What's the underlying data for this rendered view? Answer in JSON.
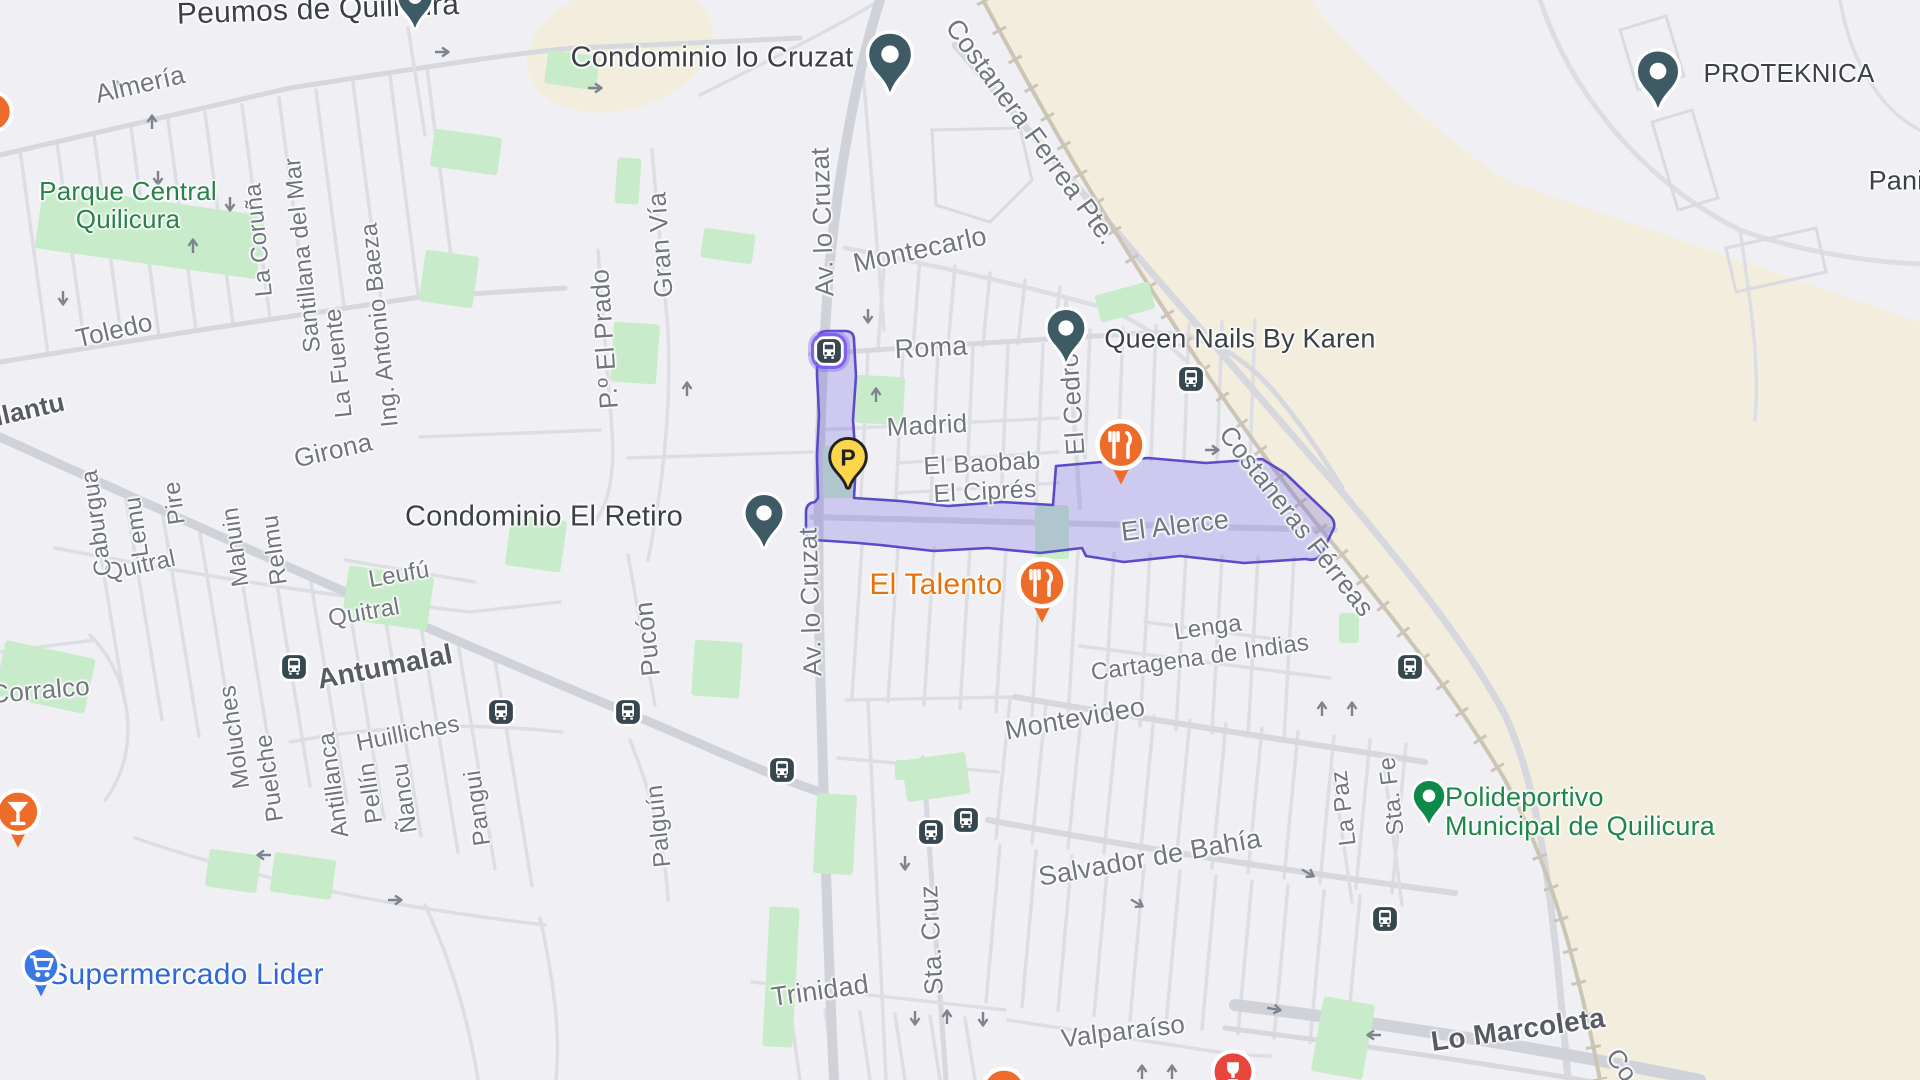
{
  "map": {
    "title": "Quilicura area street map",
    "selection": "El Alerce highlighted route"
  },
  "colors": {
    "bg": "#f0f0f4",
    "beige": "#f3edde",
    "park": "#c8ecca",
    "road": "#dcdee3",
    "road_mid": "#d6d8de",
    "road_major": "#cfd2d8",
    "rail": "#cbc5b6",
    "building": "#d9dbe0",
    "purple_fill": "rgba(106,90,225,0.26)",
    "purple_stroke": "#5b4bc8",
    "bus_bg": "#37474f",
    "pin_slate": "#3e5a64",
    "pin_green": "#0d8a47",
    "poi_orange": "#ee6c2a",
    "poi_blue": "#3b78e7",
    "poi_red": "#e8453c",
    "parking_yellow": "#fdd64b"
  },
  "labels": [
    {
      "n": "peumos-de-quilicura",
      "t": "Peumos de Quilicura",
      "x": 318,
      "y": 10,
      "r": -2,
      "s": 30,
      "c": "poi",
      "i": true
    },
    {
      "n": "condominio-lo-cruzat",
      "t": "Condominio lo Cruzat",
      "x": 712,
      "y": 58,
      "r": 0,
      "s": 29,
      "c": "poi",
      "i": true
    },
    {
      "n": "proteknica",
      "t": "PROTEKNICA",
      "x": 1789,
      "y": 73,
      "r": 0,
      "s": 26,
      "c": "poi",
      "i": true
    },
    {
      "n": "pani",
      "t": "Pani",
      "x": 1896,
      "y": 181,
      "r": 0,
      "s": 27,
      "c": "poi",
      "i": true
    },
    {
      "n": "queen-nails-by-karen",
      "t": "Queen Nails By Karen",
      "x": 1240,
      "y": 339,
      "r": 0,
      "s": 27,
      "c": "poi",
      "i": true
    },
    {
      "n": "condominio-el-retiro",
      "t": "Condominio El Retiro",
      "x": 544,
      "y": 517,
      "r": 0,
      "s": 29,
      "c": "poi",
      "i": true
    },
    {
      "n": "parque-central-quilicura",
      "t": "Parque Central\nQuilicura",
      "x": 128,
      "y": 205,
      "r": 0,
      "s": 26,
      "c": "park",
      "i": true
    },
    {
      "n": "polideportivo",
      "t": "Polideportivo\nMunicipal de Quilicura",
      "x": 1580,
      "y": 812,
      "r": 0,
      "s": 27,
      "c": "green",
      "i": true
    },
    {
      "n": "supermercado-lider",
      "t": "Supermercado Lider",
      "x": 186,
      "y": 975,
      "r": 0,
      "s": 30,
      "c": "blue",
      "i": true
    },
    {
      "n": "el-talento",
      "t": "El Talento",
      "x": 936,
      "y": 585,
      "r": 0,
      "s": 30,
      "c": "orange",
      "i": true
    },
    {
      "n": "almeria",
      "t": "Almería",
      "x": 140,
      "y": 84,
      "r": -13,
      "s": 26,
      "c": "st",
      "i": false
    },
    {
      "n": "toledo",
      "t": "Toledo",
      "x": 114,
      "y": 330,
      "r": -13,
      "s": 26,
      "c": "st",
      "i": false
    },
    {
      "n": "illantu",
      "t": "illantu",
      "x": 26,
      "y": 410,
      "r": -13,
      "s": 26,
      "c": "stm",
      "i": false
    },
    {
      "n": "girona",
      "t": "Girona",
      "x": 333,
      "y": 450,
      "r": -13,
      "s": 26,
      "c": "st",
      "i": false
    },
    {
      "n": "montecarlo",
      "t": "Montecarlo",
      "x": 920,
      "y": 250,
      "r": -12,
      "s": 27,
      "c": "st",
      "i": false
    },
    {
      "n": "roma",
      "t": "Roma",
      "x": 931,
      "y": 348,
      "r": -3,
      "s": 27,
      "c": "st",
      "i": false
    },
    {
      "n": "madrid",
      "t": "Madrid",
      "x": 927,
      "y": 425,
      "r": -3,
      "s": 26,
      "c": "st",
      "i": false
    },
    {
      "n": "el-baobab",
      "t": "El Baobab",
      "x": 982,
      "y": 464,
      "r": -3,
      "s": 25,
      "c": "st",
      "i": false
    },
    {
      "n": "el-cipres",
      "t": "El Ciprés",
      "x": 985,
      "y": 492,
      "r": -3,
      "s": 25,
      "c": "st",
      "i": false
    },
    {
      "n": "el-alerce",
      "t": "El Alerce",
      "x": 1175,
      "y": 526,
      "r": -7,
      "s": 27,
      "c": "st",
      "i": false
    },
    {
      "n": "lenga",
      "t": "Lenga",
      "x": 1208,
      "y": 628,
      "r": -8,
      "s": 24,
      "c": "st",
      "i": false
    },
    {
      "n": "cartagena-de-indias",
      "t": "Cartagena de Indias",
      "x": 1200,
      "y": 658,
      "r": -8,
      "s": 24,
      "c": "st",
      "i": false
    },
    {
      "n": "montevideo",
      "t": "Montevideo",
      "x": 1075,
      "y": 719,
      "r": -10,
      "s": 27,
      "c": "st",
      "i": false
    },
    {
      "n": "salvador-de-bahia",
      "t": "Salvador de Bahía",
      "x": 1150,
      "y": 858,
      "r": -10,
      "s": 27,
      "c": "st",
      "i": false
    },
    {
      "n": "trinidad",
      "t": "Trinidad",
      "x": 820,
      "y": 991,
      "r": -8,
      "s": 27,
      "c": "st",
      "i": false
    },
    {
      "n": "valparaiso",
      "t": "Valparaíso",
      "x": 1123,
      "y": 1031,
      "r": -7,
      "s": 26,
      "c": "st",
      "i": false
    },
    {
      "n": "lo-marcoleta",
      "t": "Lo Marcoleta",
      "x": 1518,
      "y": 1030,
      "r": -8,
      "s": 28,
      "c": "stm",
      "i": false
    },
    {
      "n": "antumalal",
      "t": "Antumalal",
      "x": 385,
      "y": 667,
      "r": -11,
      "s": 28,
      "c": "stm",
      "i": false
    },
    {
      "n": "quitral-west",
      "t": "Quitral",
      "x": 140,
      "y": 566,
      "r": -12,
      "s": 24,
      "c": "st",
      "i": false
    },
    {
      "n": "quitral-east",
      "t": "Quitral",
      "x": 364,
      "y": 613,
      "r": -10,
      "s": 24,
      "c": "st",
      "i": false
    },
    {
      "n": "leufu",
      "t": "Leufú",
      "x": 399,
      "y": 575,
      "r": -10,
      "s": 24,
      "c": "st",
      "i": false
    },
    {
      "n": "huilliches",
      "t": "Huilliches",
      "x": 408,
      "y": 734,
      "r": -11,
      "s": 24,
      "c": "st",
      "i": false
    },
    {
      "n": "corralco",
      "t": "Corralco",
      "x": 40,
      "y": 690,
      "r": -5,
      "s": 26,
      "c": "st",
      "i": false
    },
    {
      "n": "costanera-ferrea-pte",
      "t": "Costanera Ferrea Pte.",
      "x": 1031,
      "y": 132,
      "r": 54,
      "s": 27,
      "c": "st",
      "i": false
    },
    {
      "n": "costaneras-ferreas",
      "t": "Costaneras Férreas",
      "x": 1297,
      "y": 521,
      "r": 52,
      "s": 26,
      "c": "st",
      "i": false
    },
    {
      "n": "costanera-co",
      "t": "Co",
      "x": 1622,
      "y": 1065,
      "r": 55,
      "s": 26,
      "c": "st",
      "i": false
    },
    {
      "n": "la-coruna",
      "t": "La Coruña",
      "x": 259,
      "y": 240,
      "r": -96,
      "s": 24,
      "c": "st",
      "i": false
    },
    {
      "n": "santillana-del-mar",
      "t": "Santillana del Mar",
      "x": 303,
      "y": 255,
      "r": -96,
      "s": 24,
      "c": "st",
      "i": false
    },
    {
      "n": "la-fuente",
      "t": "La Fuente",
      "x": 339,
      "y": 363,
      "r": -96,
      "s": 24,
      "c": "st",
      "i": false
    },
    {
      "n": "ing-antonio-baeza",
      "t": "Ing. Antonio Baeza",
      "x": 380,
      "y": 325,
      "r": -96,
      "s": 24,
      "c": "st",
      "i": false
    },
    {
      "n": "gran-via",
      "t": "Gran Vía",
      "x": 660,
      "y": 245,
      "r": -94,
      "s": 26,
      "c": "st",
      "i": false
    },
    {
      "n": "po-el-prado",
      "t": "P.º El Prado",
      "x": 604,
      "y": 339,
      "r": -94,
      "s": 26,
      "c": "st",
      "i": false
    },
    {
      "n": "av-lo-cruzat-n",
      "t": "Av. lo Cruzat",
      "x": 822,
      "y": 222,
      "r": -92,
      "s": 26,
      "c": "st",
      "i": false
    },
    {
      "n": "av-lo-cruzat-s",
      "t": "Av. lo Cruzat",
      "x": 810,
      "y": 602,
      "r": -92,
      "s": 26,
      "c": "st",
      "i": false
    },
    {
      "n": "caburgua",
      "t": "Caburgua",
      "x": 97,
      "y": 523,
      "r": -98,
      "s": 24,
      "c": "st",
      "i": false
    },
    {
      "n": "lemu",
      "t": "Lemu",
      "x": 137,
      "y": 527,
      "r": -98,
      "s": 24,
      "c": "st",
      "i": false
    },
    {
      "n": "pire",
      "t": "Pire",
      "x": 175,
      "y": 503,
      "r": -98,
      "s": 24,
      "c": "st",
      "i": false
    },
    {
      "n": "mahuin",
      "t": "Mahuin",
      "x": 236,
      "y": 547,
      "r": -98,
      "s": 24,
      "c": "st",
      "i": false
    },
    {
      "n": "relmu",
      "t": "Relmu",
      "x": 275,
      "y": 550,
      "r": -98,
      "s": 24,
      "c": "st",
      "i": false
    },
    {
      "n": "moluches",
      "t": "Moluches",
      "x": 235,
      "y": 737,
      "r": -98,
      "s": 24,
      "c": "st",
      "i": false
    },
    {
      "n": "puelche",
      "t": "Puelche",
      "x": 270,
      "y": 778,
      "r": -98,
      "s": 24,
      "c": "st",
      "i": false
    },
    {
      "n": "antillanca",
      "t": "Antillanca",
      "x": 334,
      "y": 785,
      "r": -98,
      "s": 24,
      "c": "st",
      "i": false
    },
    {
      "n": "pellin",
      "t": "Pellín",
      "x": 371,
      "y": 793,
      "r": -98,
      "s": 24,
      "c": "st",
      "i": false
    },
    {
      "n": "nancu",
      "t": "Ñancu",
      "x": 405,
      "y": 798,
      "r": -98,
      "s": 24,
      "c": "st",
      "i": false
    },
    {
      "n": "pangui",
      "t": "Pangui",
      "x": 478,
      "y": 808,
      "r": -98,
      "s": 24,
      "c": "st",
      "i": false
    },
    {
      "n": "palguin",
      "t": "Palguín",
      "x": 659,
      "y": 826,
      "r": -96,
      "s": 24,
      "c": "st",
      "i": false
    },
    {
      "n": "pucon",
      "t": "Pucón",
      "x": 647,
      "y": 639,
      "r": -96,
      "s": 26,
      "c": "st",
      "i": false
    },
    {
      "n": "el-cedro",
      "t": "El Cedro",
      "x": 1072,
      "y": 404,
      "r": -94,
      "s": 26,
      "c": "st",
      "i": false
    },
    {
      "n": "sta-cruz",
      "t": "Sta. Cruz",
      "x": 931,
      "y": 940,
      "r": -93,
      "s": 26,
      "c": "st",
      "i": false
    },
    {
      "n": "la-paz",
      "t": "La Paz",
      "x": 1344,
      "y": 808,
      "r": -97,
      "s": 24,
      "c": "st",
      "i": false
    },
    {
      "n": "sta-fe",
      "t": "Sta. Fe",
      "x": 1392,
      "y": 796,
      "r": -97,
      "s": 24,
      "c": "st",
      "i": false
    }
  ],
  "markers": [
    {
      "k": "pin",
      "n": "peumos-pin",
      "x": 415,
      "y": -4,
      "w": 42
    },
    {
      "k": "pin",
      "n": "condominio-lo-cruzat-pin",
      "x": 890,
      "y": 53,
      "w": 52
    },
    {
      "k": "pin",
      "n": "condominio-el-retiro-pin",
      "x": 764,
      "y": 512,
      "w": 46
    },
    {
      "k": "pin",
      "n": "queen-nails-pin",
      "x": 1066,
      "y": 327,
      "w": 46
    },
    {
      "k": "pin",
      "n": "proteknica-pin",
      "x": 1658,
      "y": 70,
      "w": 50
    },
    {
      "k": "pin-green",
      "n": "polideportivo-pin",
      "x": 1429,
      "y": 795,
      "w": 38
    },
    {
      "k": "restaurant",
      "n": "restaurant-el-cedro-pin",
      "x": 1121,
      "y": 445,
      "w": 60
    },
    {
      "k": "restaurant",
      "n": "el-talento-pin",
      "x": 1042,
      "y": 583,
      "w": 60
    },
    {
      "k": "cocktail",
      "n": "bar-pin",
      "x": 18,
      "y": 812,
      "w": 54
    },
    {
      "k": "cart",
      "n": "supermercado-lider-pin",
      "x": 41,
      "y": 966,
      "w": 46
    },
    {
      "k": "parking",
      "n": "parking-pin",
      "x": 848,
      "y": 453,
      "l": "P"
    },
    {
      "k": "bus",
      "n": "bus-stop-antumalal-1",
      "x": 294,
      "y": 667
    },
    {
      "k": "bus",
      "n": "bus-stop-antumalal-2",
      "x": 501,
      "y": 712
    },
    {
      "k": "bus",
      "n": "bus-stop-antumalal-3",
      "x": 628,
      "y": 712
    },
    {
      "k": "bus",
      "n": "bus-stop-montevideo",
      "x": 782,
      "y": 770
    },
    {
      "k": "bus",
      "n": "bus-stop-salvador-1",
      "x": 931,
      "y": 832
    },
    {
      "k": "bus",
      "n": "bus-stop-salvador-2",
      "x": 966,
      "y": 820
    },
    {
      "k": "bus",
      "n": "bus-stop-costanera-n",
      "x": 1191,
      "y": 379
    },
    {
      "k": "bus",
      "n": "bus-stop-costanera-s",
      "x": 1410,
      "y": 667
    },
    {
      "k": "bus",
      "n": "bus-stop-la-paz",
      "x": 1385,
      "y": 919
    },
    {
      "k": "bus-selected",
      "n": "bus-stop-roma-selected",
      "x": 829,
      "y": 351
    },
    {
      "k": "red",
      "n": "red-poi-pin",
      "x": 1233,
      "y": 1072,
      "w": 52
    },
    {
      "k": "orange-dot",
      "n": "orange-poi-partial-bottom",
      "x": 1004,
      "y": 1090,
      "w": 54
    },
    {
      "k": "orange-dot",
      "n": "orange-poi-partial-left",
      "x": -8,
      "y": 112,
      "w": 50
    }
  ]
}
